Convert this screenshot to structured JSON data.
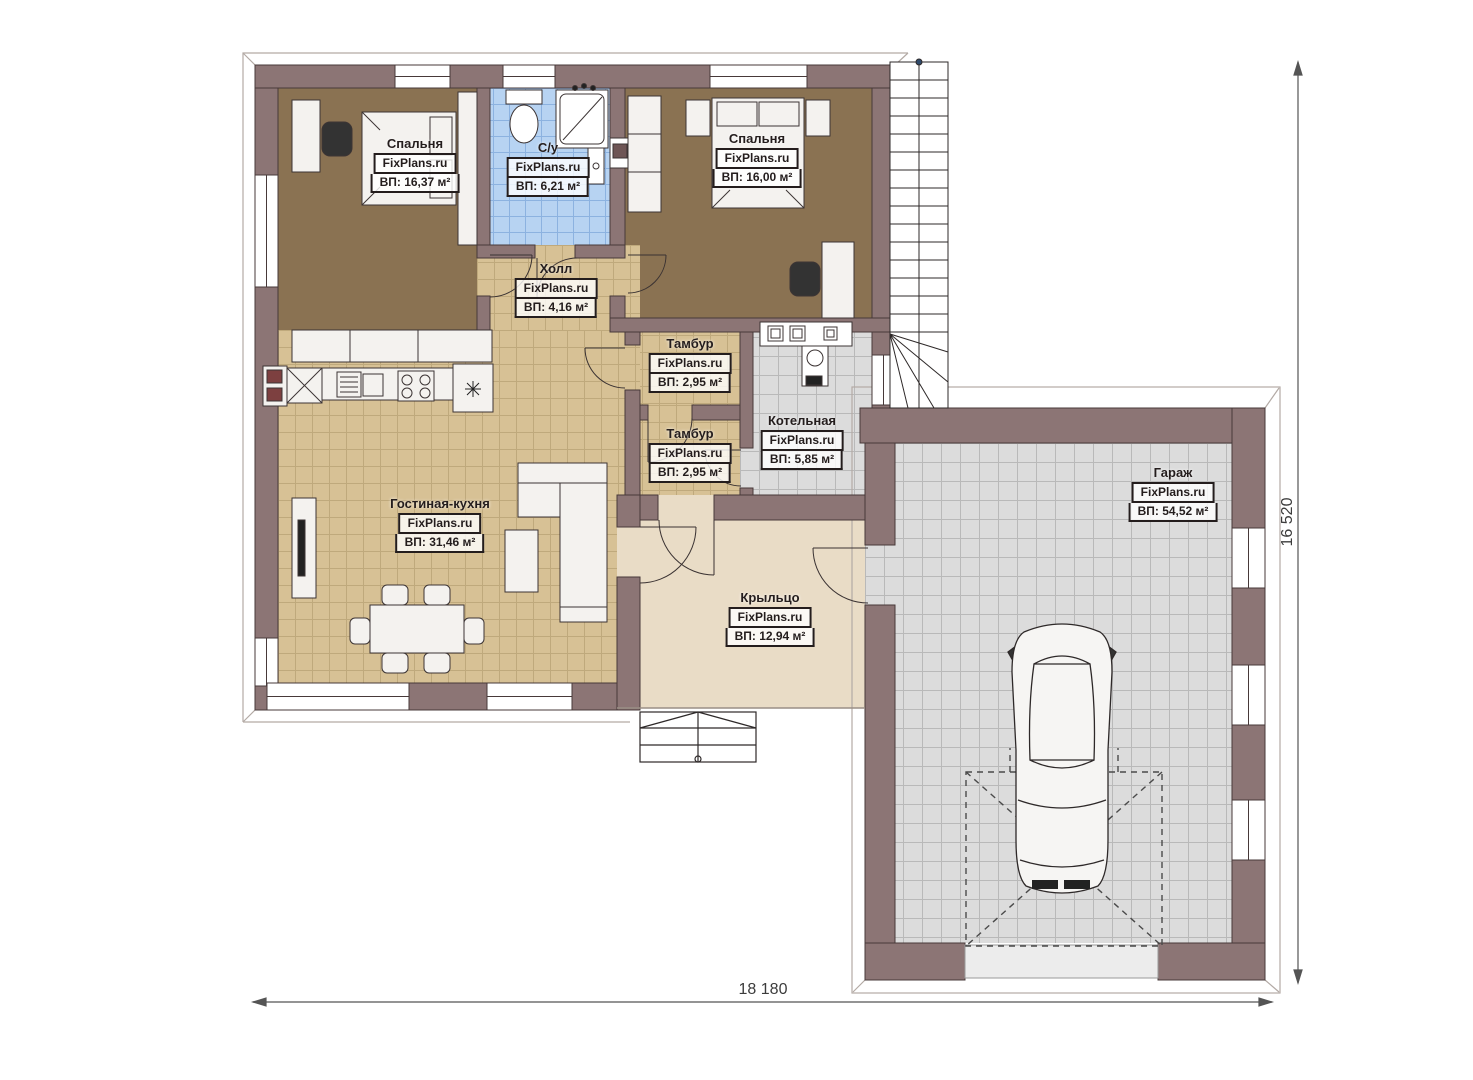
{
  "plan": {
    "watermark": "FixPlans.ru",
    "rooms": {
      "bedroom1": {
        "name": "Спальня",
        "area": "ВП: 16,37 м²"
      },
      "bathroom": {
        "name": "С/у",
        "area": "ВП: 6,21 м²"
      },
      "bedroom2": {
        "name": "Спальня",
        "area": "ВП: 16,00 м²"
      },
      "hall": {
        "name": "Холл",
        "area": "ВП: 4,16 м²"
      },
      "tambour1": {
        "name": "Тамбур",
        "area": "ВП: 2,95 м²"
      },
      "tambour2": {
        "name": "Тамбур",
        "area": "ВП: 2,95 м²"
      },
      "boiler": {
        "name": "Котельная",
        "area": "ВП: 5,85 м²"
      },
      "living": {
        "name": "Гостиная-кухня",
        "area": "ВП: 31,46 м²"
      },
      "porch": {
        "name": "Крыльцо",
        "area": "ВП: 12,94 м²"
      },
      "garage": {
        "name": "Гараж",
        "area": "ВП: 54,52 м²"
      }
    },
    "dimensions": {
      "width_mm": "18 180",
      "height_mm": "16 520"
    },
    "colors": {
      "wall": "#8c7575",
      "bedroom_floor": "#8a7252",
      "tile_tan": "#d7c195",
      "tile_blue": "#b7d3f2",
      "tile_gray": "#dcdcdc",
      "porch": "#e9dcc6",
      "appliance_red": "#7d4040"
    }
  }
}
